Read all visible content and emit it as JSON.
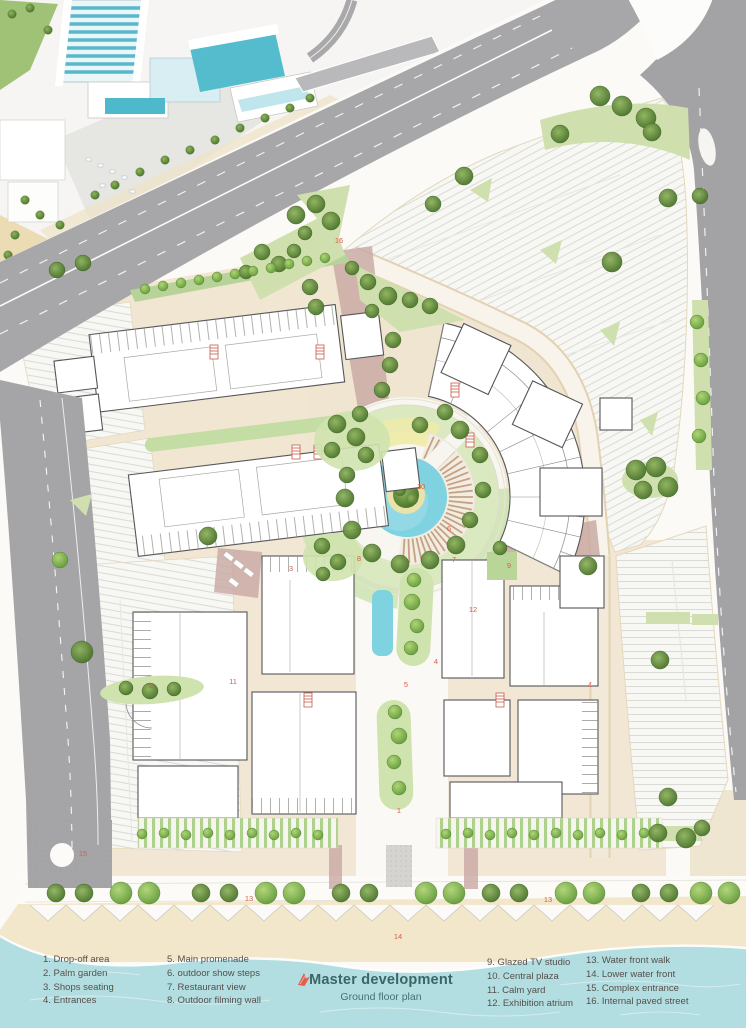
{
  "title": {
    "main": "Master development",
    "sub": "Ground floor plan"
  },
  "legend": {
    "columns": [
      [
        "1. Drop-off area",
        "2. Palm garden",
        "3. Shops seating",
        "4. Entrances"
      ],
      [
        "5. Main promenade",
        "6. outdoor show steps",
        "7. Restaurant view",
        "8. Outdoor filming wall"
      ],
      [
        "9. Glazed TV studio",
        "10. Central plaza",
        "11. Calm yard",
        "12. Exhibition atrium"
      ],
      [
        "13. Water front walk",
        "14. Lower water front",
        "15. Complex entrance",
        "16. Internal paved street"
      ]
    ]
  },
  "plan": {
    "markers": [
      {
        "n": "16",
        "x": 339,
        "y": 243
      },
      {
        "n": "10",
        "x": 421,
        "y": 489
      },
      {
        "n": "6",
        "x": 449,
        "y": 531
      },
      {
        "n": "8",
        "x": 359,
        "y": 561
      },
      {
        "n": "7",
        "x": 454,
        "y": 562
      },
      {
        "n": "9",
        "x": 509,
        "y": 568
      },
      {
        "n": "12",
        "x": 473,
        "y": 612
      },
      {
        "n": "4",
        "x": 436,
        "y": 664
      },
      {
        "n": "4",
        "x": 590,
        "y": 687
      },
      {
        "n": "11",
        "x": 233,
        "y": 684
      },
      {
        "n": "5",
        "x": 406,
        "y": 687
      },
      {
        "n": "2",
        "x": 151,
        "y": 688
      },
      {
        "n": "3",
        "x": 291,
        "y": 571
      },
      {
        "n": "1",
        "x": 399,
        "y": 813
      },
      {
        "n": "15",
        "x": 83,
        "y": 856
      },
      {
        "n": "13",
        "x": 249,
        "y": 901
      },
      {
        "n": "13",
        "x": 548,
        "y": 902
      },
      {
        "n": "14",
        "x": 398,
        "y": 939
      }
    ]
  },
  "colors": {
    "road": "#a7a7a9",
    "water": "#b2dde1",
    "sand": "#f2e6cb",
    "beige": "#f1e6d1",
    "pool": "#7fd2e0",
    "tree_bright": "#679d3c",
    "tree_dark": "#46702c",
    "mauve": "#c8a7a2",
    "accent_red": "#d95f48",
    "title_color": "#3c6565"
  }
}
